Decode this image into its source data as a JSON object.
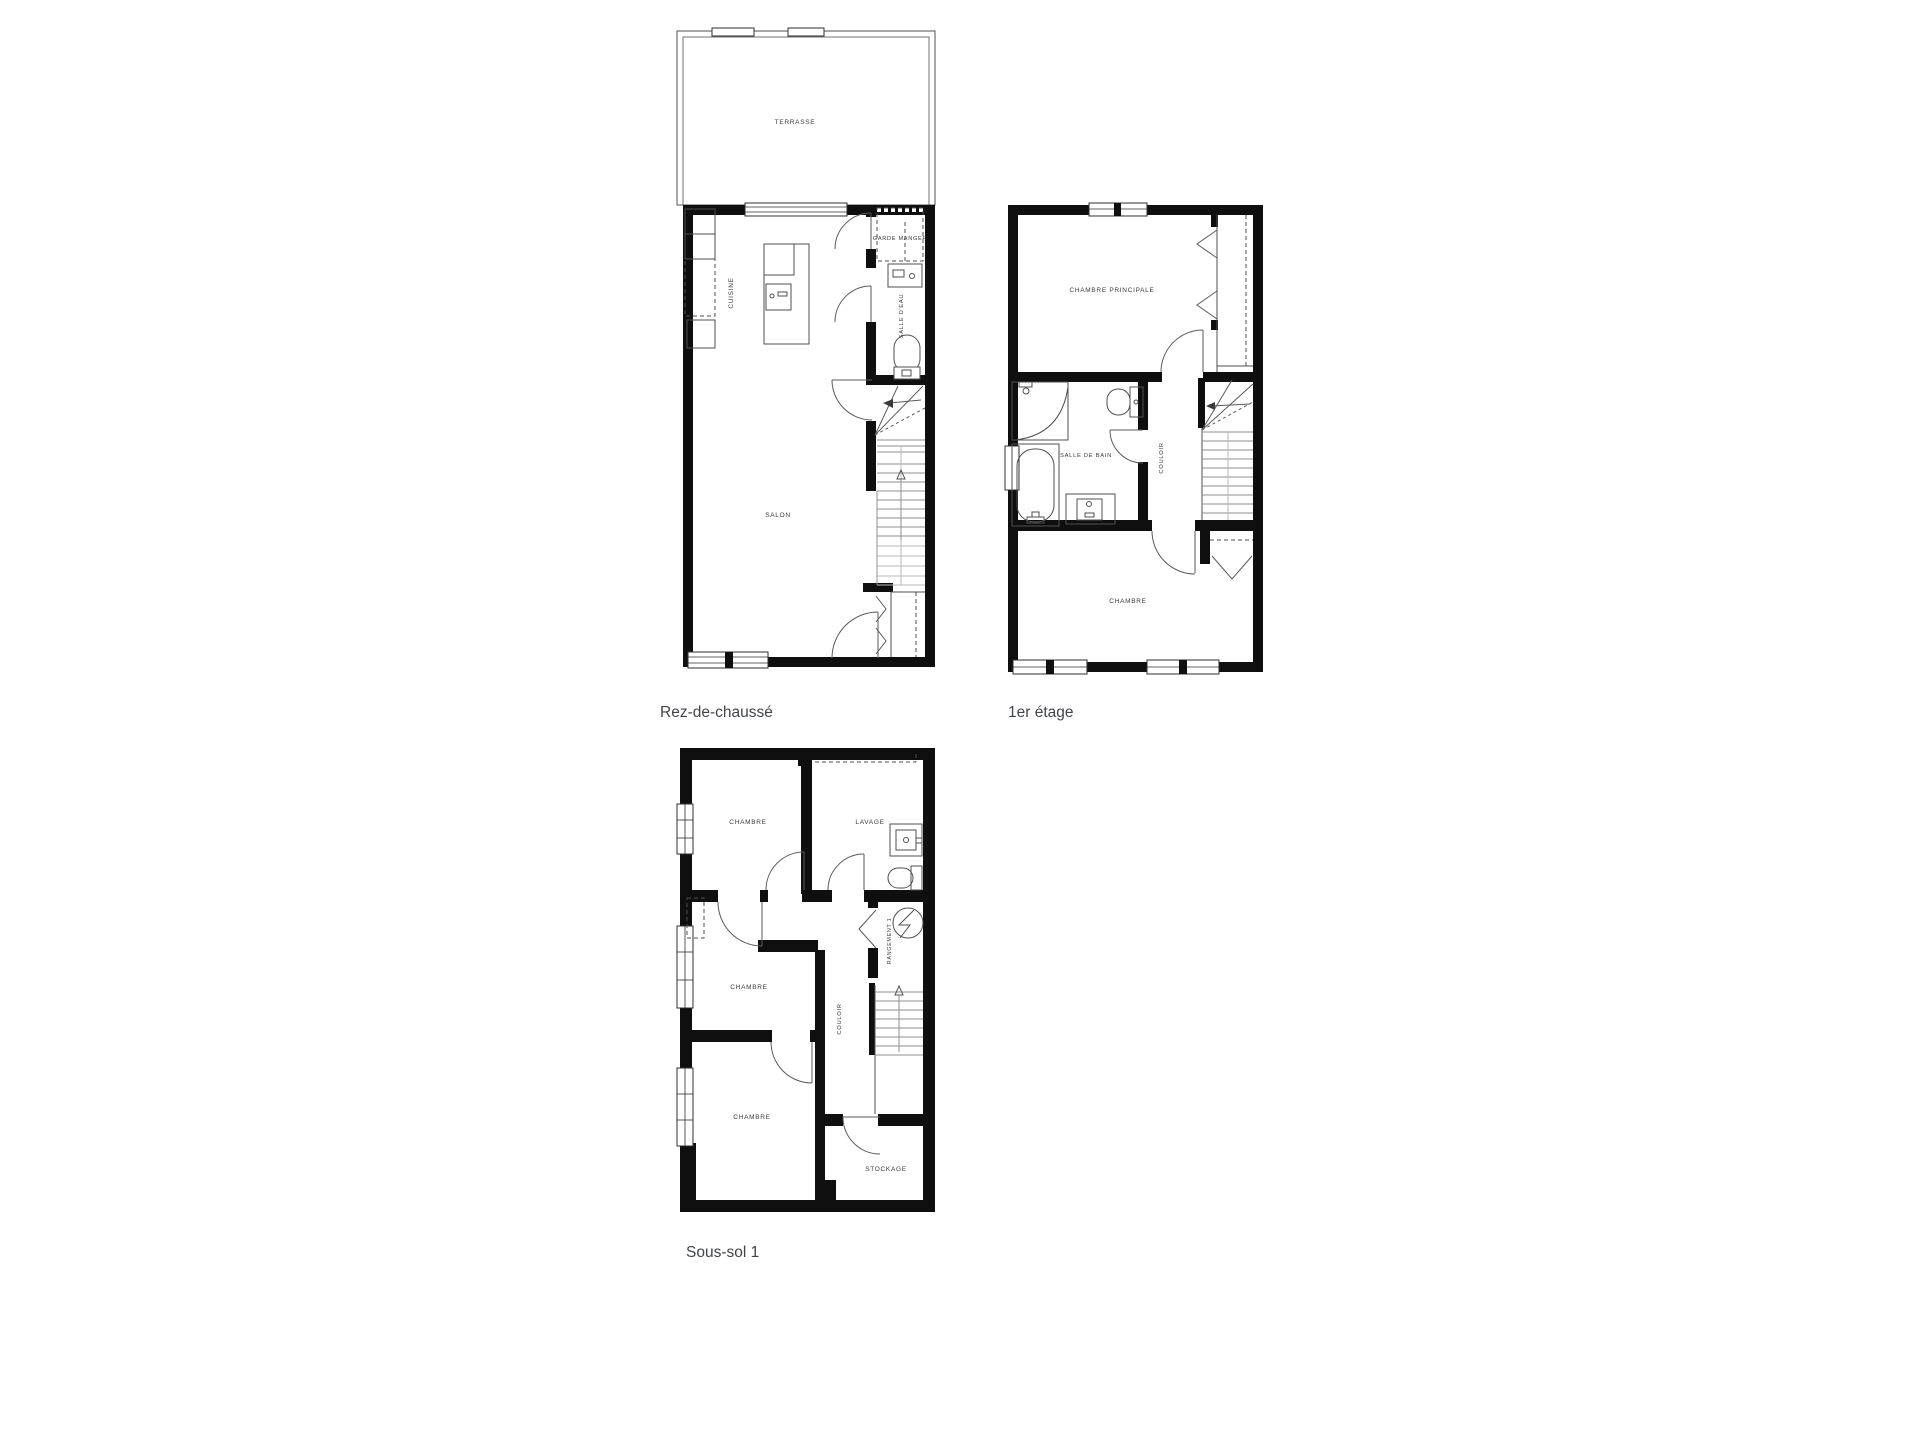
{
  "colors": {
    "background": "#ffffff",
    "wall": "#0f0f0f",
    "line": "#4f4f4f",
    "door": "#5a5a5a",
    "step": "#8f8f8f",
    "step_light": "#b9b9b9",
    "label": "#3a3a3a",
    "floor_label": "#41454a"
  },
  "floors": [
    {
      "label": "Rez-de-chaussé",
      "rooms": {
        "terrasse": "TERRASSE",
        "cuisine": "CUISINE",
        "garde_manger": "GARDE MANGER",
        "salle_deau": "SALLE D'EAU",
        "salon": "SALON"
      }
    },
    {
      "label": "1er étage",
      "rooms": {
        "chambre_principale": "CHAMBRE PRINCIPALE",
        "salle_de_bain": "SALLE DE BAIN",
        "couloir": "COULOIR",
        "chambre": "CHAMBRE"
      }
    },
    {
      "label": "Sous-sol 1",
      "rooms": {
        "chambre_1": "CHAMBRE",
        "lavage": "LAVAGE",
        "chambre_2": "CHAMBRE",
        "rangement": "RANGEMENT 1",
        "couloir": "COULOIR",
        "chambre_3": "CHAMBRE",
        "stockage": "STOCKAGE"
      }
    }
  ]
}
